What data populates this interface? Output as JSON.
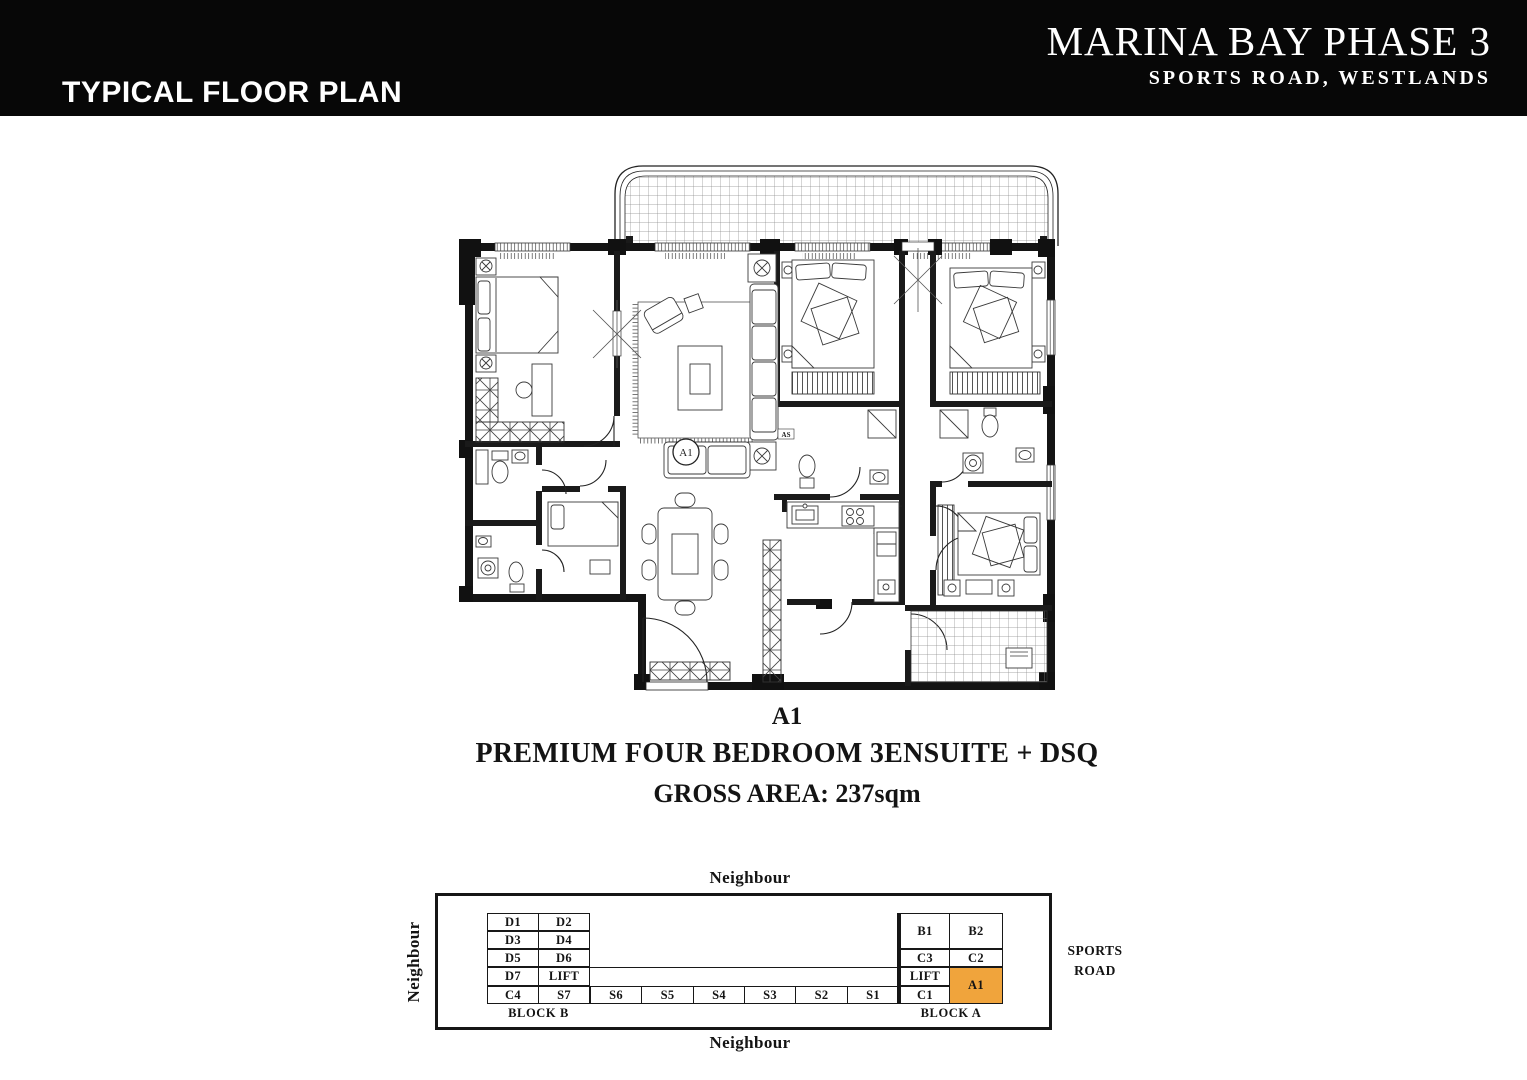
{
  "header": {
    "section_label": "TYPICAL FLOOR PLAN",
    "project_title": "MARINA BAY PHASE 3",
    "project_subtitle": "SPORTS ROAD, WESTLANDS"
  },
  "plan": {
    "unit_marker": "A1",
    "bath_label": "AS"
  },
  "caption": {
    "unit": "A1",
    "description": "PREMIUM FOUR BEDROOM 3ENSUITE + DSQ",
    "gross_area": "GROSS AREA: 237sqm"
  },
  "site_map": {
    "neighbour_top": "Neighbour",
    "neighbour_bottom": "Neighbour",
    "neighbour_left": "Neighbour",
    "road_line1": "SPORTS",
    "road_line2": "ROAD",
    "block_b_label": "BLOCK B",
    "block_a_label": "BLOCK A",
    "highlight_color": "#F0A43C",
    "block_b": {
      "d1": "D1",
      "d2": "D2",
      "d3": "D3",
      "d4": "D4",
      "d5": "D5",
      "d6": "D6",
      "d7": "D7",
      "lift": "LIFT",
      "c4": "C4",
      "s7": "S7"
    },
    "strip": {
      "s6": "S6",
      "s5": "S5",
      "s4": "S4",
      "s3": "S3",
      "s2": "S2",
      "s1": "S1"
    },
    "block_a": {
      "b1": "B1",
      "b2": "B2",
      "c3": "C3",
      "c2": "C2",
      "lift": "LIFT",
      "c1": "C1",
      "a1": "A1"
    }
  }
}
